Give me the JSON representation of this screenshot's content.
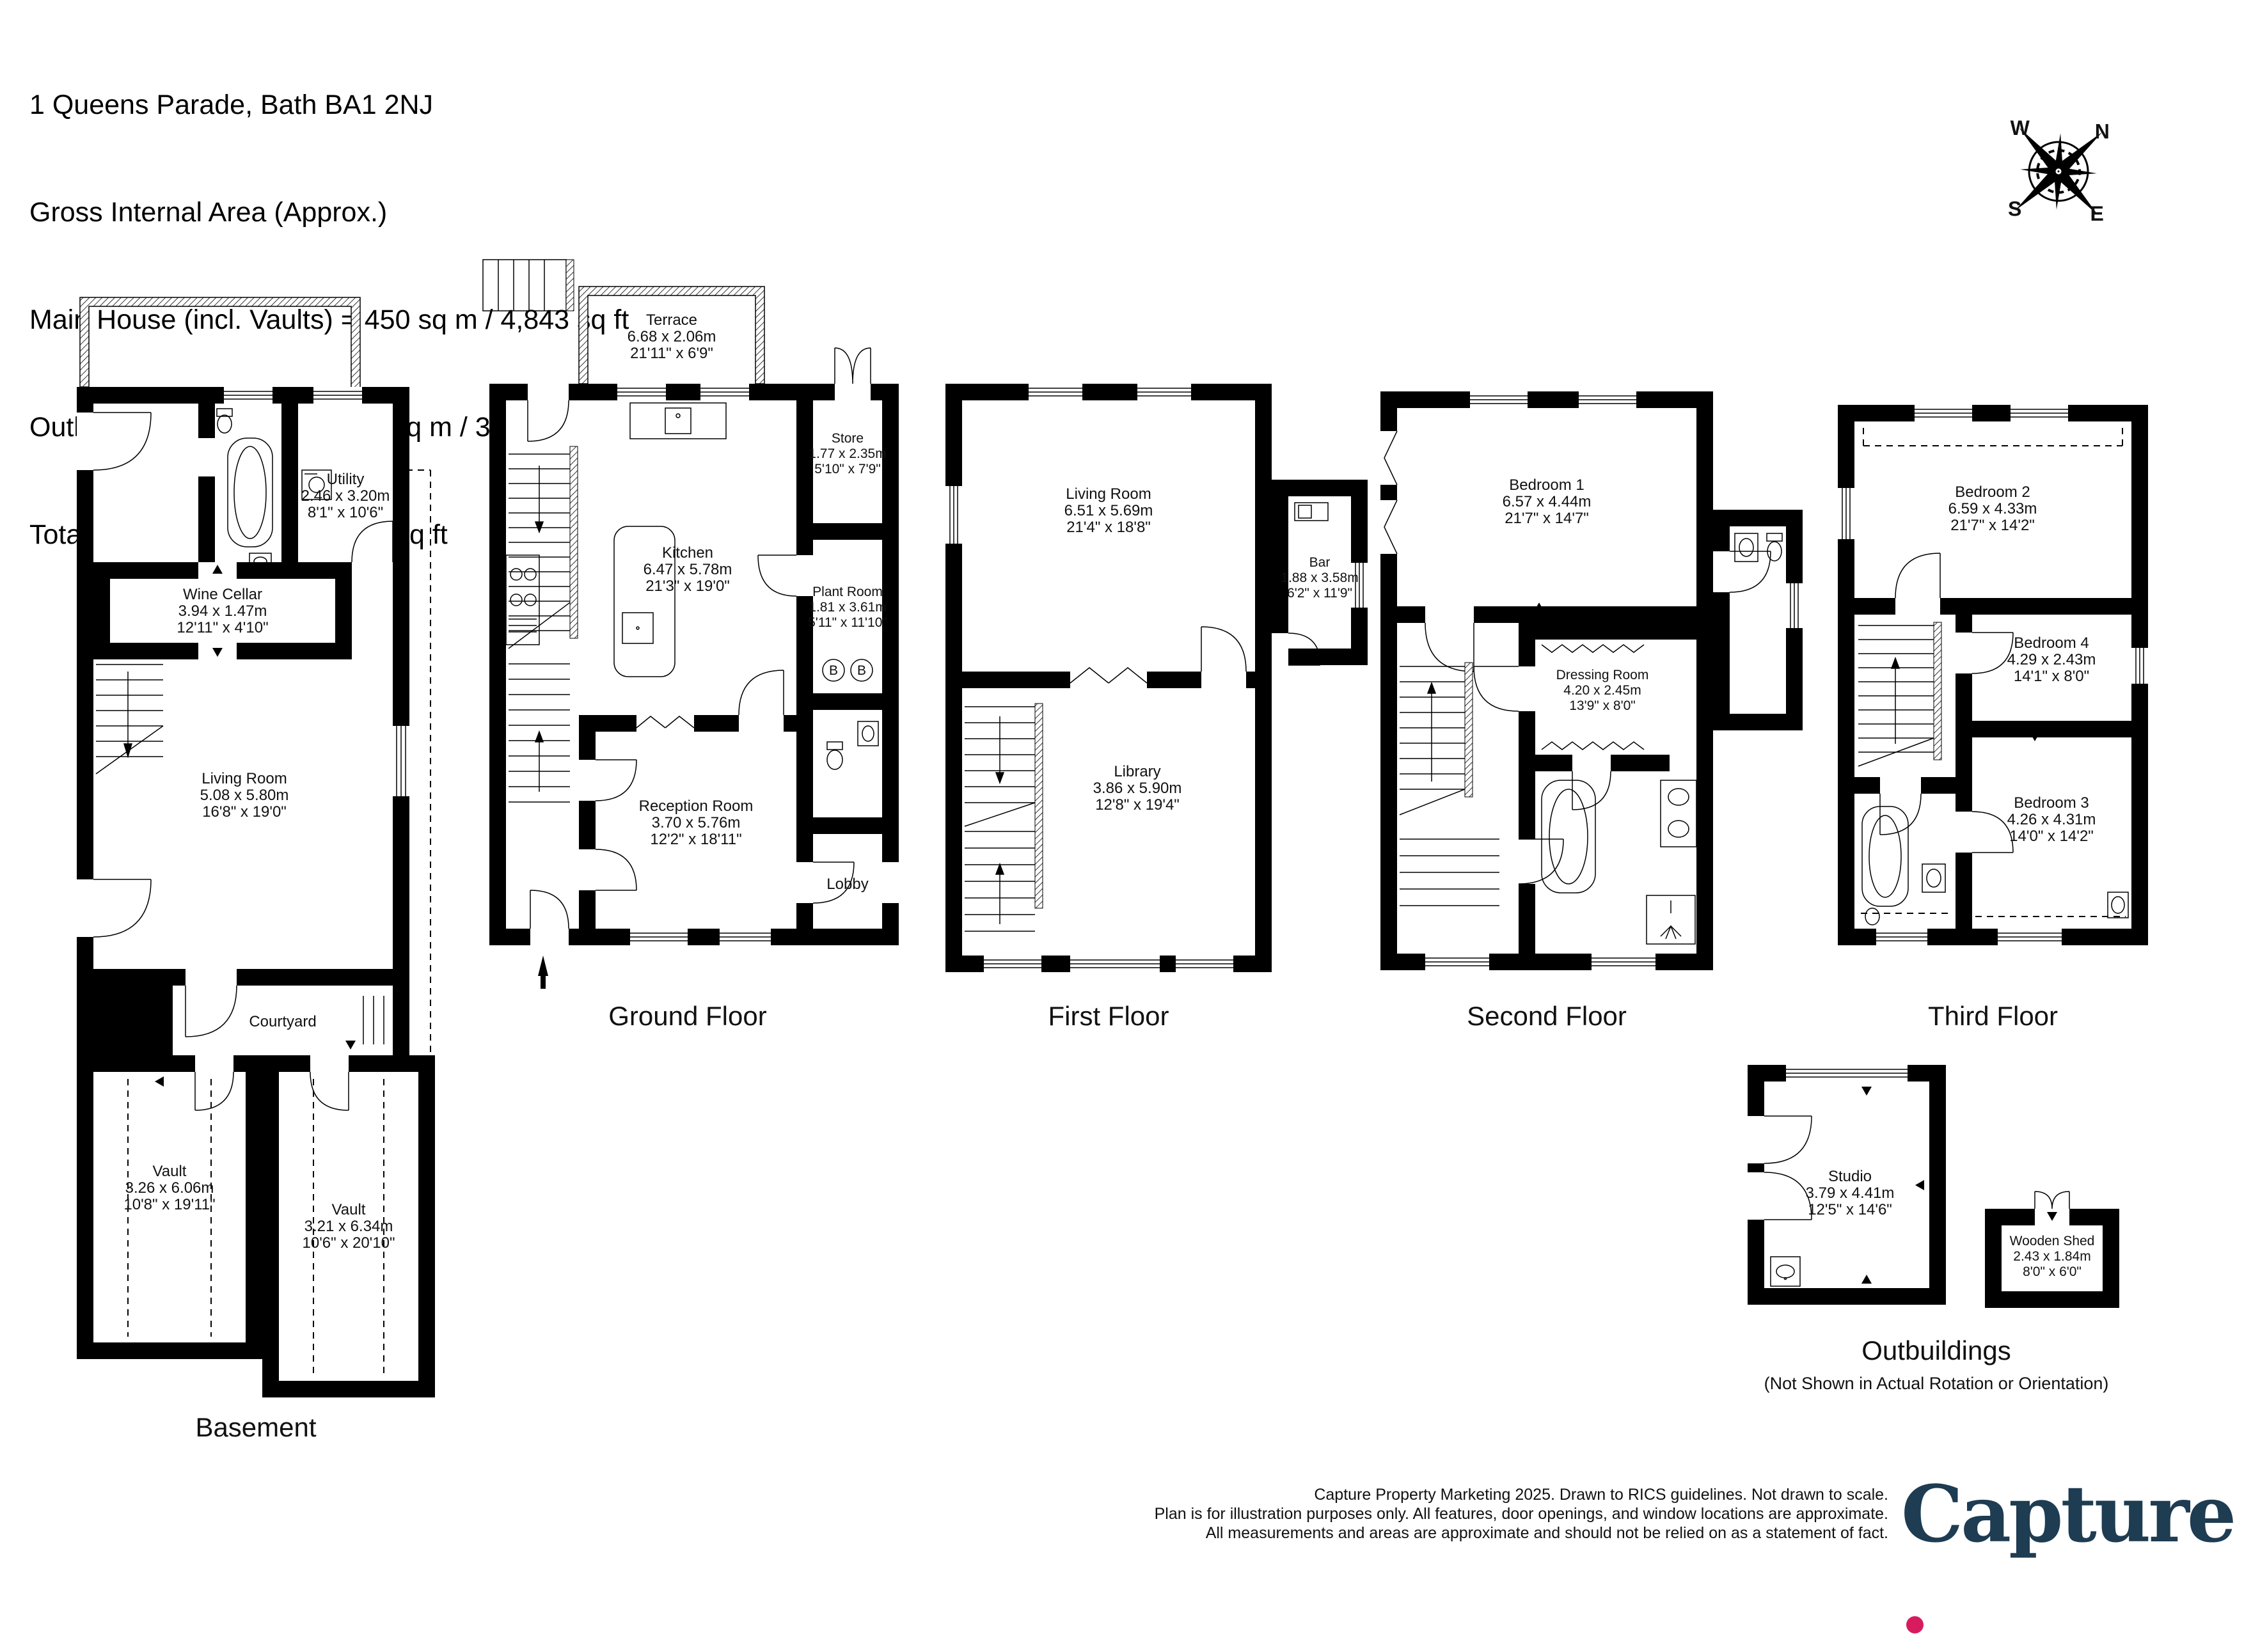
{
  "header": {
    "address": "1 Queens Parade, Bath BA1 2NJ",
    "gia": "Gross Internal Area (Approx.)",
    "main_house": "Main House (incl. Vaults) = 450 sq m / 4,843 sq ft",
    "outbuildings": "Outbuildings and Stores = 32 sq m / 344 sq ft",
    "total": "Total Area = 482 sq m / 5,187 sq ft"
  },
  "compass": {
    "n": "N",
    "e": "E",
    "s": "S",
    "w": "W"
  },
  "floors": {
    "basement": {
      "label": "Basement",
      "utility": {
        "name": "Utility",
        "metric": "2.46 x 3.20m",
        "imperial": "8'1\" x 10'6\""
      },
      "wine_cellar": {
        "name": "Wine Cellar",
        "metric": "3.94 x 1.47m",
        "imperial": "12'11\" x 4'10\""
      },
      "living_room": {
        "name": "Living Room",
        "metric": "5.08 x 5.80m",
        "imperial": "16'8\" x 19'0\""
      },
      "courtyard": {
        "name": "Courtyard"
      },
      "vault_left": {
        "name": "Vault",
        "metric": "3.26 x 6.06m",
        "imperial": "10'8\" x 19'11\""
      },
      "vault_right": {
        "name": "Vault",
        "metric": "3.21 x 6.34m",
        "imperial": "10'6\" x 20'10\""
      }
    },
    "ground": {
      "label": "Ground Floor",
      "boiler": "B",
      "terrace": {
        "name": "Terrace",
        "metric": "6.68 x 2.06m",
        "imperial": "21'11\" x 6'9\""
      },
      "kitchen": {
        "name": "Kitchen",
        "metric": "6.47 x 5.78m",
        "imperial": "21'3\" x 19'0\""
      },
      "store": {
        "name": "Store",
        "metric": "1.77 x 2.35m",
        "imperial": "5'10\" x 7'9\""
      },
      "plant_room": {
        "name": "Plant Room",
        "metric": "1.81 x 3.61m",
        "imperial": "5'11\" x 11'10\""
      },
      "reception": {
        "name": "Reception Room",
        "metric": "3.70 x 5.76m",
        "imperial": "12'2\" x 18'11\""
      },
      "lobby": {
        "name": "Lobby"
      }
    },
    "first": {
      "label": "First Floor",
      "living_room": {
        "name": "Living Room",
        "metric": "6.51 x 5.69m",
        "imperial": "21'4\" x 18'8\""
      },
      "bar": {
        "name": "Bar",
        "metric": "1.88 x 3.58m",
        "imperial": "6'2\" x 11'9\""
      },
      "library": {
        "name": "Library",
        "metric": "3.86 x 5.90m",
        "imperial": "12'8\" x 19'4\""
      }
    },
    "second": {
      "label": "Second Floor",
      "bedroom1": {
        "name": "Bedroom 1",
        "metric": "6.57 x 4.44m",
        "imperial": "21'7\" x 14'7\""
      },
      "dressing": {
        "name": "Dressing Room",
        "metric": "4.20 x 2.45m",
        "imperial": "13'9\" x 8'0\""
      }
    },
    "third": {
      "label": "Third Floor",
      "bedroom2": {
        "name": "Bedroom 2",
        "metric": "6.59 x 4.33m",
        "imperial": "21'7\" x 14'2\""
      },
      "bedroom4": {
        "name": "Bedroom 4",
        "metric": "4.29 x 2.43m",
        "imperial": "14'1\" x 8'0\""
      },
      "bedroom3": {
        "name": "Bedroom 3",
        "metric": "4.26 x 4.31m",
        "imperial": "14'0\" x 14'2\""
      }
    }
  },
  "outbuildings": {
    "label": "Outbuildings",
    "note": "(Not Shown in Actual Rotation or Orientation)",
    "studio": {
      "name": "Studio",
      "metric": "3.79 x 4.41m",
      "imperial": "12'5\" x 14'6\""
    },
    "shed": {
      "name": "Wooden Shed",
      "metric": "2.43 x 1.84m",
      "imperial": "8'0\" x 6'0\""
    }
  },
  "footer": {
    "line1": "Capture Property Marketing 2025. Drawn to RICS guidelines.  Not drawn to scale.",
    "line2": "Plan is for illustration purposes only. All features, door openings, and window locations are approximate.",
    "line3": "All measurements and areas are approximate and should not be relied on as a statement of fact.",
    "brand": "Capture"
  },
  "colors": {
    "brand_navy": "#1e3c52",
    "brand_pink": "#d81b5f",
    "walls": "#000000"
  }
}
